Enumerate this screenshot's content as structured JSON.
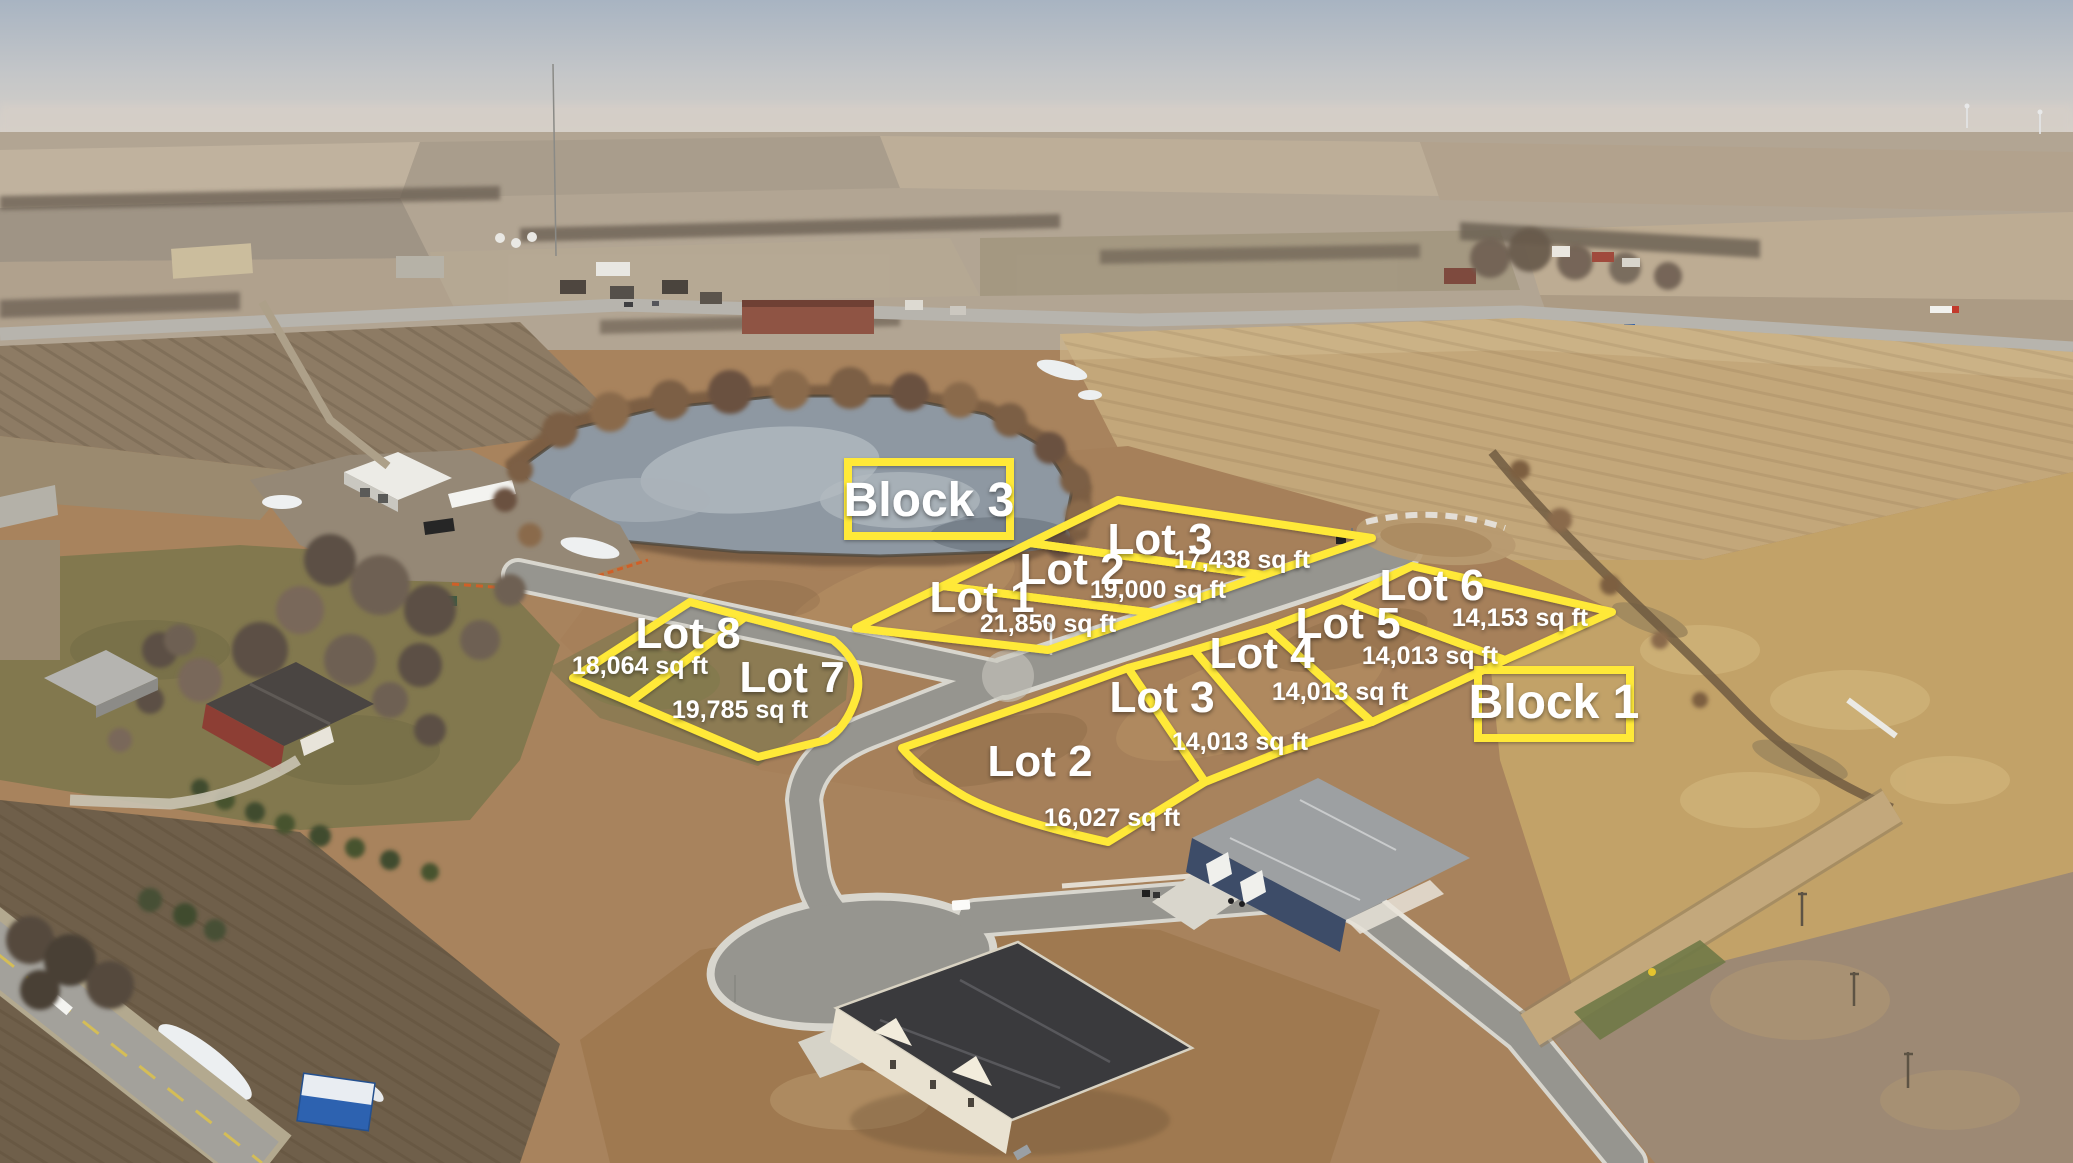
{
  "annotations": {
    "colors": {
      "outline_yellow": "#FFE937",
      "label_text": "#FFFFFF"
    },
    "block_labels": [
      {
        "text": "Block 3"
      },
      {
        "text": "Block 1"
      }
    ],
    "lot_groups": [
      {
        "id": "north-group",
        "lots": [
          {
            "name": "Lot 1",
            "area": "21,850 sq ft"
          },
          {
            "name": "Lot 2",
            "area": "19,000 sq ft"
          },
          {
            "name": "Lot 3",
            "area": "17,438 sq ft"
          }
        ]
      },
      {
        "id": "west-group",
        "lots": [
          {
            "name": "Lot 8",
            "area": "18,064 sq ft"
          },
          {
            "name": "Lot 7",
            "area": "19,785 sq ft"
          }
        ]
      },
      {
        "id": "south-group",
        "lots": [
          {
            "name": "Lot 2",
            "area": "16,027 sq ft"
          },
          {
            "name": "Lot 3",
            "area": "14,013 sq ft"
          },
          {
            "name": "Lot 4",
            "area": "14,013 sq ft"
          },
          {
            "name": "Lot 5",
            "area": "14,013 sq ft"
          },
          {
            "name": "Lot 6",
            "area": "14,153 sq ft"
          }
        ]
      }
    ]
  }
}
